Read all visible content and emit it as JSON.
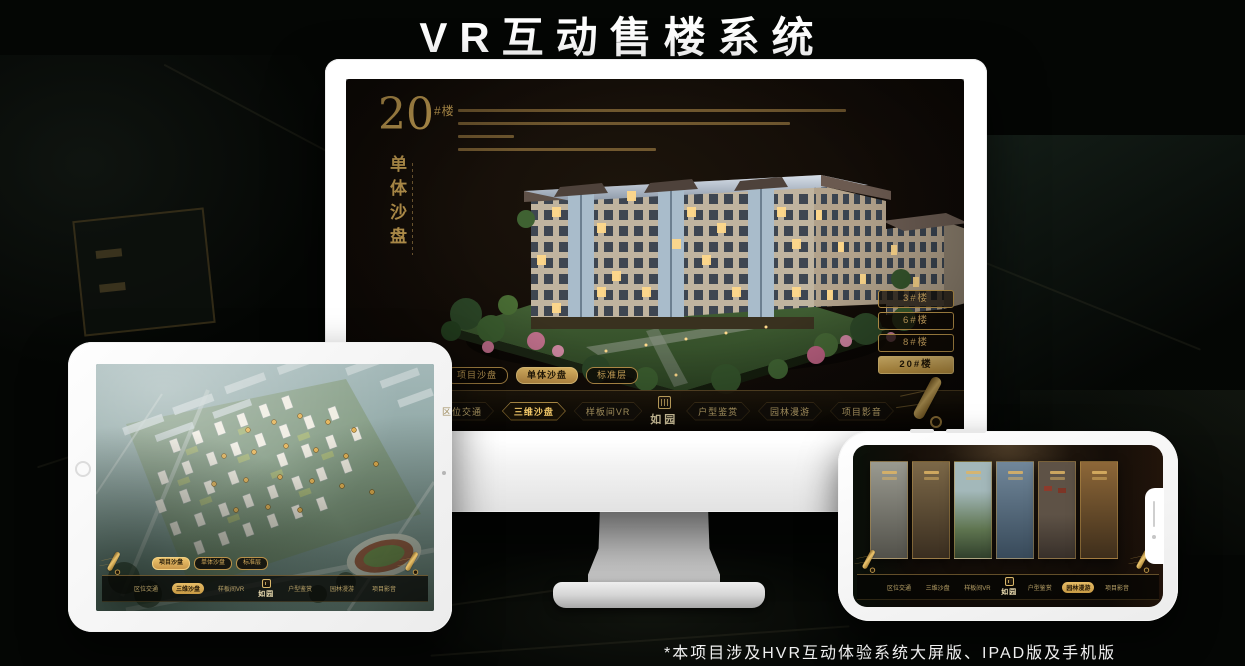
{
  "page": {
    "title": "VR互动售楼系统",
    "footnote": "*本项目涉及HVR互动体验系统大屏版、IPAD版及手机版"
  },
  "brand": {
    "logo_text": "如园"
  },
  "nav": {
    "items": [
      "区位交通",
      "三维沙盘",
      "样板间VR",
      "户型鉴赏",
      "园林漫游",
      "项目影音"
    ]
  },
  "subtabs": {
    "items": [
      "项目沙盘",
      "单体沙盘",
      "标准层"
    ]
  },
  "monitor": {
    "heading_number": "20",
    "heading_unit": "#楼",
    "heading_subtitle": "单体沙盘",
    "active_subtab": "单体沙盘",
    "active_nav": "三维沙盘",
    "buildings": [
      "3#楼",
      "6#楼",
      "8#楼",
      "20#楼"
    ],
    "active_building": "20#楼"
  },
  "ipad": {
    "active_subtab": "项目沙盘",
    "active_nav": "三维沙盘"
  },
  "phone": {
    "active_nav": "园林漫游"
  },
  "colors": {
    "accent_gold": "#d2a855",
    "active_tab_bg": "#d9b05c",
    "screen_bg": "#15100a"
  }
}
